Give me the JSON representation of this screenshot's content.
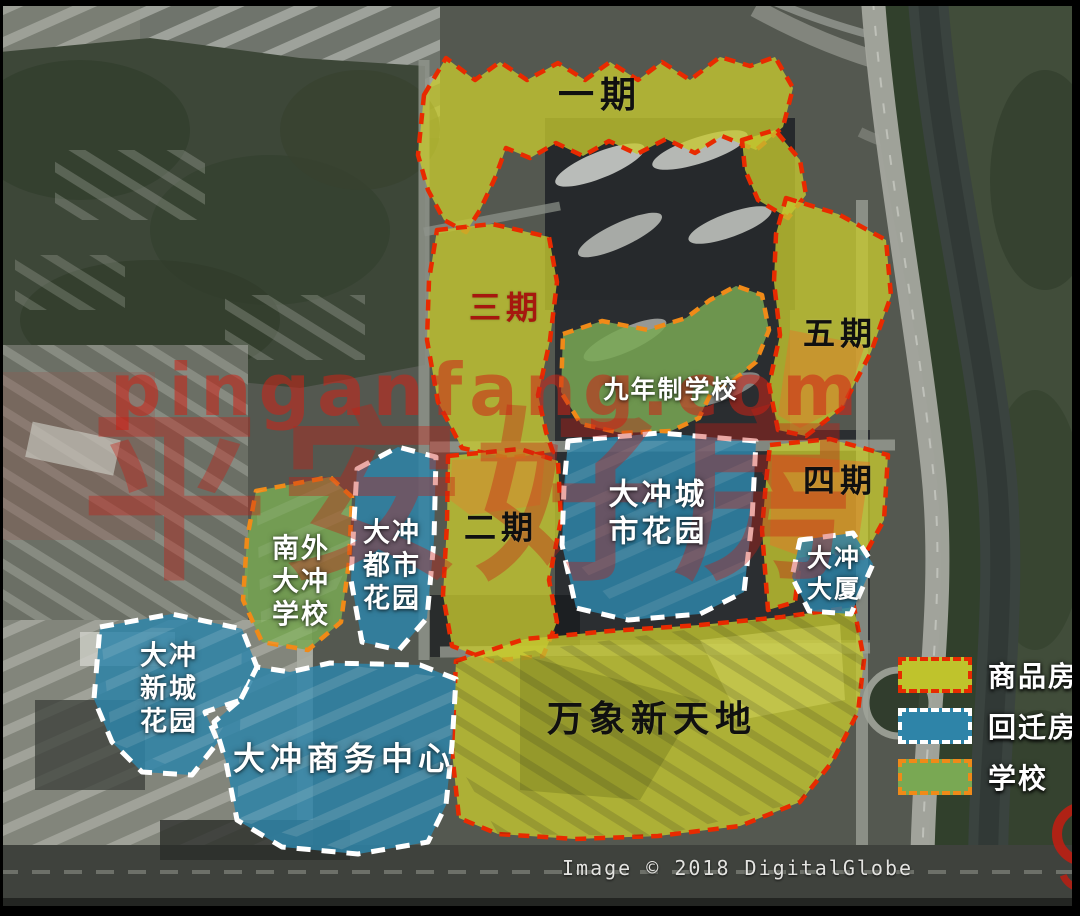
{
  "zones": {
    "phase1": {
      "label": "一期",
      "type": "commodity"
    },
    "phase2": {
      "label": "二期",
      "type": "commodity"
    },
    "phase3": {
      "label": "三期",
      "type": "commodity"
    },
    "phase4": {
      "label": "四期",
      "type": "commodity"
    },
    "phase5": {
      "label": "五期",
      "type": "commodity"
    },
    "wanxiang": {
      "label": "万象新天地",
      "type": "commodity"
    },
    "school9": {
      "label": "九年制学校",
      "type": "school"
    },
    "nanwai": {
      "line1": "南外",
      "line2": "大冲",
      "line3": "学校",
      "type": "school"
    },
    "city_garden": {
      "line1": "大冲城",
      "line2": "市花园",
      "type": "relocation"
    },
    "tower": {
      "line1": "大冲",
      "line2": "大厦",
      "type": "relocation"
    },
    "dushi": {
      "line1": "大冲",
      "line2": "都市",
      "line3": "花园",
      "type": "relocation"
    },
    "xincheng": {
      "line1": "大冲",
      "line2": "新城",
      "line3": "花园",
      "type": "relocation"
    },
    "shangwu": {
      "label": "大冲商务中心",
      "type": "relocation"
    }
  },
  "legend": {
    "items": [
      {
        "label": "商品房",
        "fill": "#bfc32c",
        "border": "#e62b00"
      },
      {
        "label": "回迁房",
        "fill": "#2e84a8",
        "border": "#ffffff"
      },
      {
        "label": "学校",
        "fill": "#79a853",
        "border": "#f08a18"
      }
    ]
  },
  "watermark": {
    "site": "pinganfang.com",
    "brand": "平安好房"
  },
  "attribution": "Image © 2018 DigitalGlobe"
}
